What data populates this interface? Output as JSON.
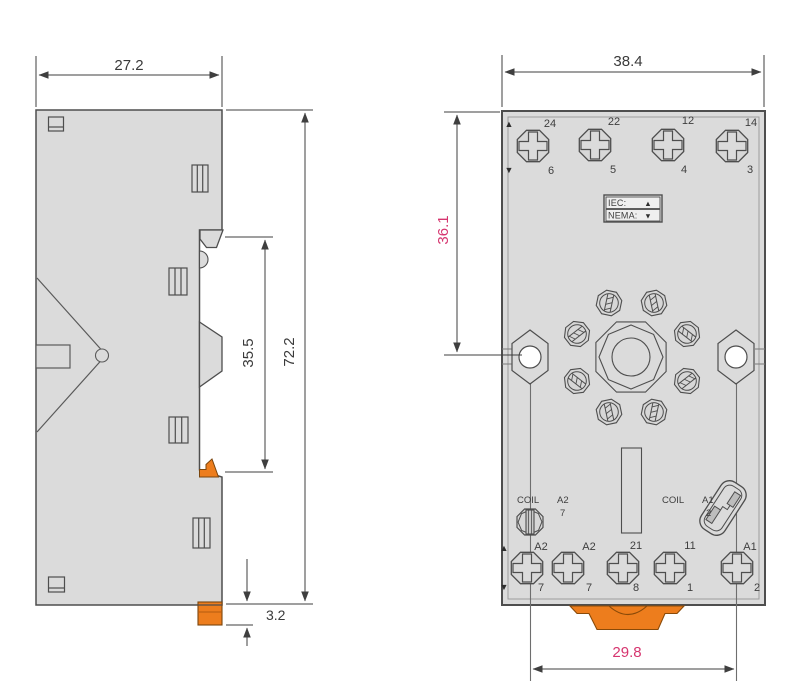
{
  "drawing_title": "Relay socket dimension drawing (side and front views)",
  "colors": {
    "body_fill": "#dbdbdb",
    "outline": "#4e4e4e",
    "inner_line": "#9c9c9c",
    "orange_accent": "#ed7d1d",
    "pink_dim_text": "#d6356f",
    "dim_line": "#3f3f3f"
  },
  "side_view": {
    "name": "side-view",
    "dims": {
      "width": "27.2",
      "height": "72.2",
      "recess": "35.5",
      "foot": "3.2"
    }
  },
  "front_view": {
    "name": "front-view",
    "dims": {
      "width": "38.4",
      "top_to_hole": "36.1",
      "hole_spacing": "29.8"
    },
    "badge": {
      "iec_label": "IEC:",
      "nema_label": "NEMA:",
      "up": "▲",
      "down": "▼"
    },
    "top_row": {
      "up": "▲",
      "down": "▼",
      "terminals": [
        {
          "upper": "24",
          "lower": "6"
        },
        {
          "upper": "22",
          "lower": "5"
        },
        {
          "upper": "12",
          "lower": "4"
        },
        {
          "upper": "14",
          "lower": "3"
        }
      ]
    },
    "coil_left": {
      "label": "COIL",
      "code": "A2",
      "pin": "7"
    },
    "coil_right": {
      "label": "COIL",
      "code": "A1",
      "pin": "2"
    },
    "bottom_row": {
      "up": "▲",
      "down": "▼",
      "terminals": [
        {
          "upper": "A2",
          "lower": "7"
        },
        {
          "upper": "A2",
          "lower": "7"
        },
        {
          "upper": "21",
          "lower": "8"
        },
        {
          "upper": "11",
          "lower": "1"
        },
        {
          "upper": "A1",
          "lower": "2"
        }
      ]
    }
  }
}
